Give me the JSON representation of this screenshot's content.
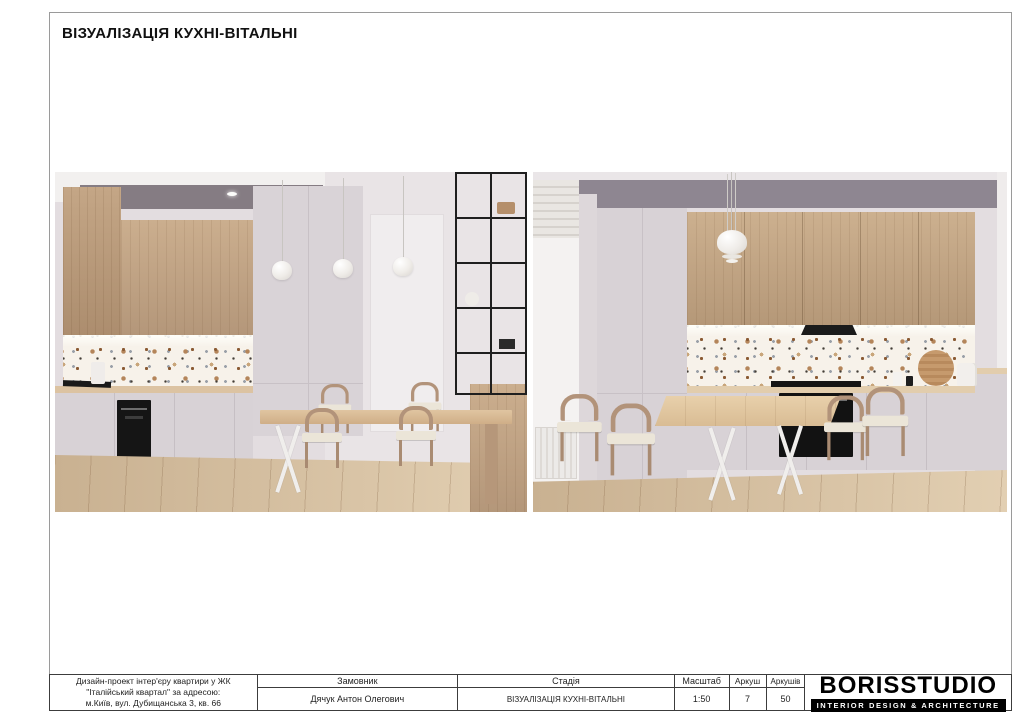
{
  "page": {
    "title": "ВІЗУАЛІЗАЦІЯ КУХНІ-ВІТАЛЬНІ"
  },
  "colors": {
    "wall": "#ddd6da",
    "cabinet_gray": "#d8d2d6",
    "wood_cabinet": "#b99b7c",
    "wood_floor": "#cfb99c",
    "terrazzo_base": "#f7f2ea",
    "appliance_black": "#161616",
    "table_wood": "#dcc19e",
    "frame_border": "#9a9a9a",
    "titleblock_border": "#3c3c3c"
  },
  "titleblock": {
    "project": {
      "lines": [
        "Дизайн-проект інтер'єру квартири у ЖК",
        "\"Італійський квартал\" за адресою:",
        "м.Київ, вул. Дубищанська 3, кв. 66"
      ]
    },
    "customer": {
      "label": "Замовник",
      "value": "Дячук Антон Олегович"
    },
    "stage": {
      "label": "Стадія",
      "value": "ВІЗУАЛІЗАЦІЯ КУХНІ-ВІТАЛЬНІ"
    },
    "scale": {
      "label": "Масштаб",
      "value": "1:50"
    },
    "sheet": {
      "label": "Аркуш",
      "value": "7"
    },
    "sheets": {
      "label": "Аркушів",
      "value": "50"
    },
    "logo": {
      "name": "BORISSTUDIO",
      "tagline": "INTERIOR DESIGN & ARCHITECTURE"
    }
  }
}
